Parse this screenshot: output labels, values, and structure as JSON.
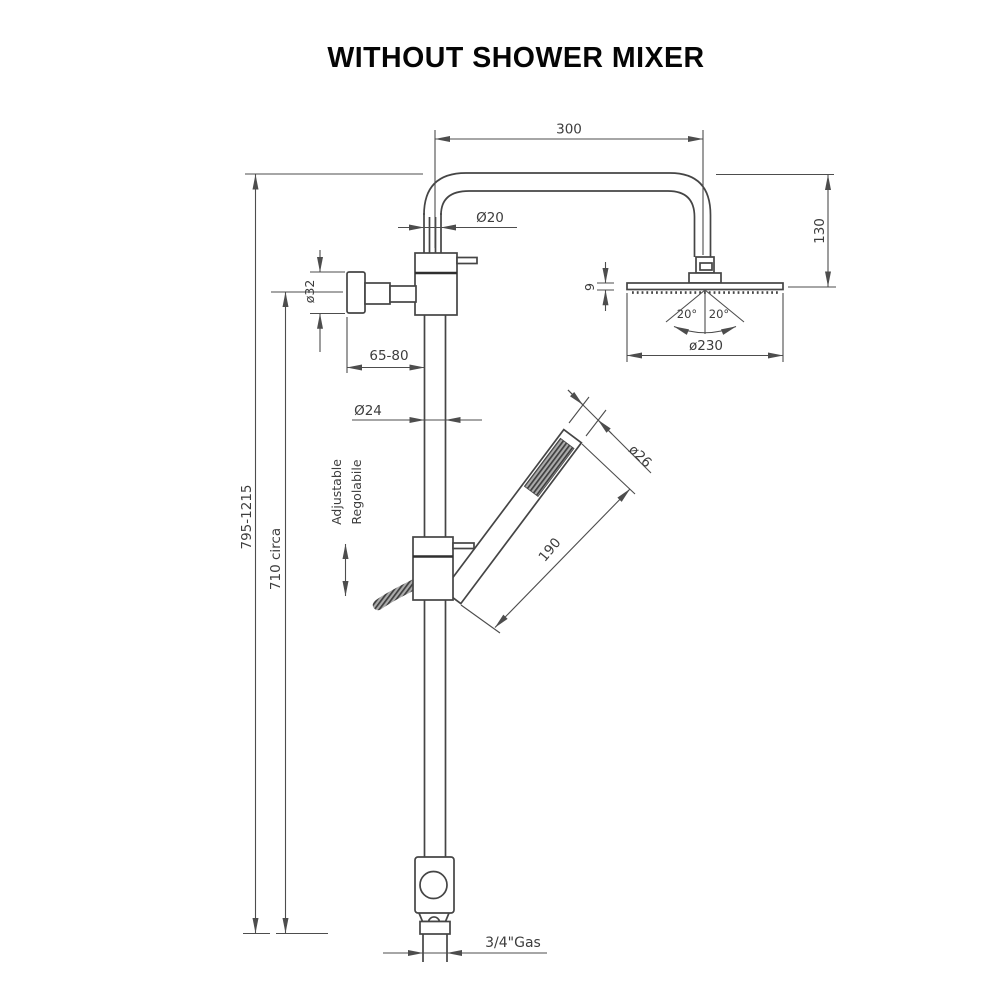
{
  "title": "WITHOUT SHOWER MIXER",
  "drawing": {
    "type": "technical-dimension-drawing",
    "subject": "shower column without mixer",
    "labels": {
      "arm_length": "300",
      "arm_pipe_diameter": "Ø20",
      "head_drop": "130",
      "head_thickness": "9",
      "spray_angle_left": "20°",
      "spray_angle_right": "20°",
      "head_diameter": "ø230",
      "total_height": "795-1215",
      "bracket_height": "710 circa",
      "knob_diameter": "ø32",
      "wall_distance": "65-80",
      "riser_diameter": "Ø24",
      "adjustable_en": "Adjustable",
      "adjustable_it": "Regolabile",
      "handshower_length": "190",
      "handshower_diameter": "ø26",
      "inlet_thread": "3/4\"Gas"
    },
    "colors": {
      "background": "#ffffff",
      "object_line": "#454545",
      "dimension_line": "#4d4d4d",
      "text": "#3d3d3d",
      "title_text": "#050505"
    }
  }
}
